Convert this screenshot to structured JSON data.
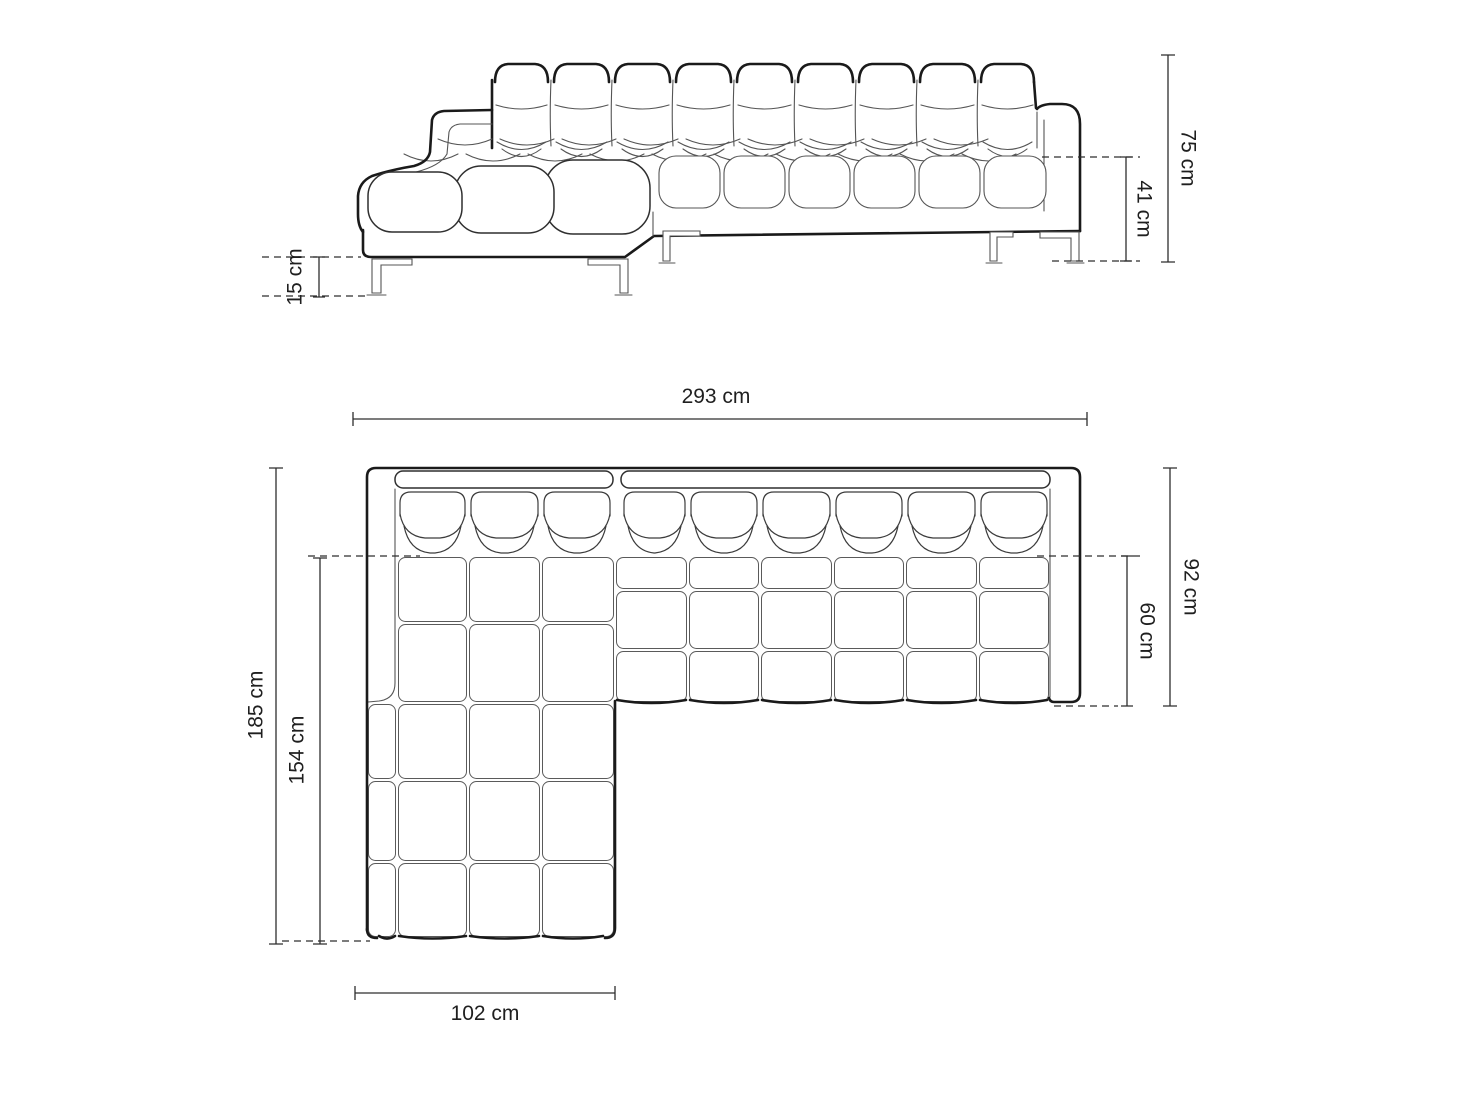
{
  "diagram": {
    "unit": "cm",
    "colors": {
      "background": "#ffffff",
      "outline": "#1a1a1a",
      "detail_line": "#555555",
      "dimension_line": "#2e2e2e",
      "label_text": "#1f1f1f"
    },
    "front_view": {
      "dims": {
        "total_height": "75 cm",
        "seat_height": "41 cm",
        "leg_height": "15 cm"
      }
    },
    "top_view": {
      "dims": {
        "total_width": "293 cm",
        "total_depth": "92 cm",
        "seat_depth": "60 cm",
        "total_length": "185 cm",
        "chaise_length": "154 cm",
        "chaise_width": "102 cm"
      }
    }
  }
}
